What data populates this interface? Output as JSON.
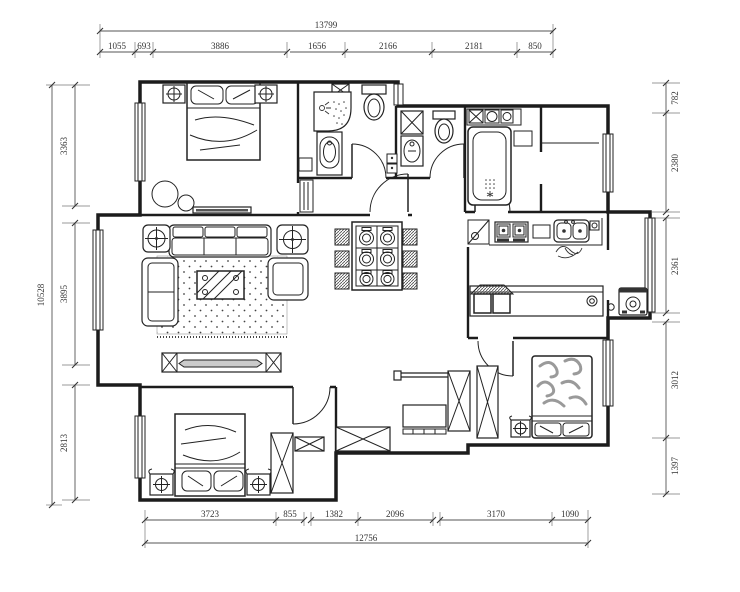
{
  "dimensions": {
    "top": {
      "total": "13799",
      "segments": [
        "1055",
        "693",
        "3886",
        "1656",
        "2166",
        "2181",
        "850"
      ]
    },
    "bottom": {
      "total": "12756",
      "segments": [
        "3723",
        "855",
        "1382",
        "2096",
        "3170",
        "1090"
      ]
    },
    "left": {
      "total": "10528",
      "segments": [
        "3363",
        "3895",
        "2813"
      ]
    },
    "right": {
      "segments": [
        "782",
        "2380",
        "2361",
        "3012",
        "1397"
      ]
    }
  }
}
